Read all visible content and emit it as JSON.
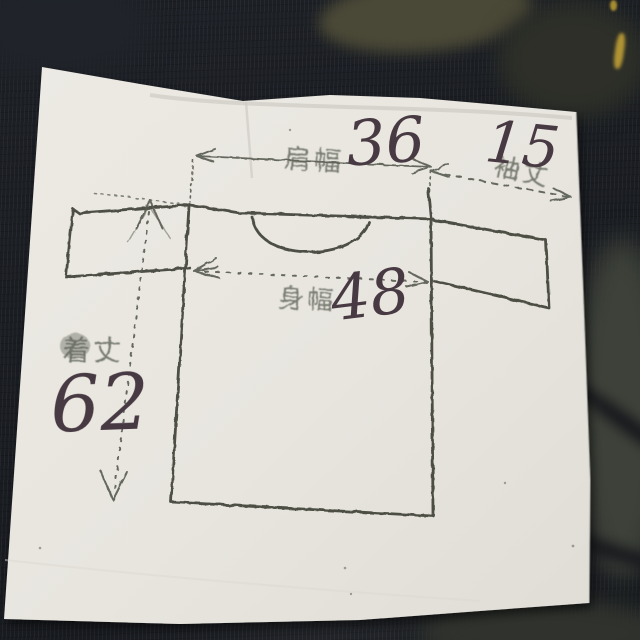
{
  "scene": {
    "description": "photo of a hand-stamped t-shirt size diagram on paper lying on dark knit fabric",
    "colors": {
      "fabric_base": "#1a1d22",
      "fabric_olive_patch": "#4a4836",
      "fabric_yellow_sliver": "#b09334",
      "paper": "#e9e6e0",
      "sketch_ink": "#3f4337",
      "stamp_label_ink": "#60645a",
      "pen_ink": "#483a43"
    }
  },
  "diagram": {
    "garment": "t-shirt",
    "measurements": [
      {
        "label": "肩幅",
        "value": "36"
      },
      {
        "label": "袖丈",
        "value": "15"
      },
      {
        "label": "身幅",
        "value": "48"
      },
      {
        "label": "着丈",
        "value": "62"
      }
    ]
  }
}
